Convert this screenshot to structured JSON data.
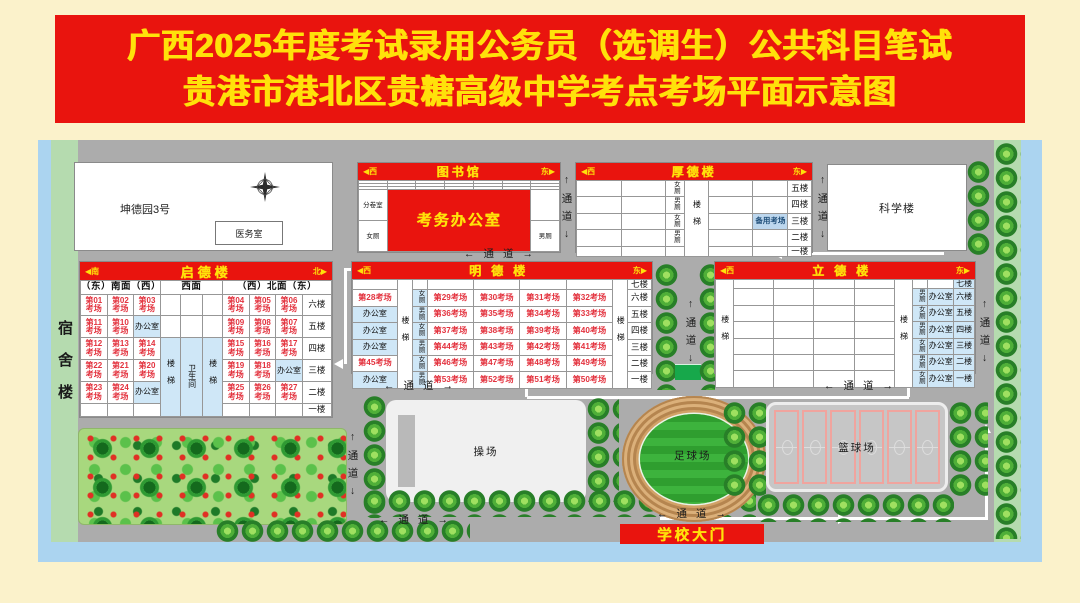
{
  "title": {
    "line1": "广西2025年度考试录用公务员（选调生）公共科目笔试",
    "line2": "贵港市港北区贵糖高级中学考点考场平面示意图"
  },
  "passage_v": "↑通道↓",
  "passage_h": "←通道→",
  "dorm": {
    "label": "宿舍楼"
  },
  "kunde": {
    "label": "坤德园3号",
    "clinic": "医务室"
  },
  "science": {
    "label": "科学楼"
  },
  "oper": {
    "label": "操场"
  },
  "football": {
    "label": "足球场"
  },
  "basketball": {
    "label": "篮球场"
  },
  "gate": {
    "label": "学校大门"
  },
  "library": {
    "dl": "◀西",
    "name": "图书馆",
    "dr": "东▶",
    "grid": {
      "colw": [
        14.3,
        14.3,
        14.3,
        14.3,
        14.3,
        14.3,
        14.2
      ],
      "rows": [
        [
          "",
          "",
          "",
          "",
          "",
          "",
          ""
        ],
        [
          "",
          "",
          "",
          "",
          "",
          "",
          ""
        ],
        [
          "",
          "",
          "",
          "",
          "",
          "",
          ""
        ],
        [
          {
            "t": "分卷室",
            "c": "tiny"
          },
          {
            "t": "考务办公室",
            "c": "banner",
            "cs": 5,
            "rs": 2
          },
          ""
        ],
        [
          {
            "t": "女厕",
            "c": "tiny"
          },
          {
            "t": "男厕",
            "c": "tiny"
          }
        ]
      ]
    }
  },
  "houde": {
    "dl": "◀西",
    "name": "厚德楼",
    "dr": "东▶",
    "grid": {
      "colw": [
        19,
        19,
        8,
        10,
        19,
        15,
        10
      ],
      "rows": [
        [
          "",
          "",
          {
            "t": "女厕",
            "c": "w"
          },
          {
            "t": "楼梯",
            "c": "s st",
            "rs": 5
          },
          "",
          "",
          {
            "t": "五楼",
            "c": "f"
          }
        ],
        [
          "",
          "",
          {
            "t": "男厕",
            "c": "w"
          },
          "",
          "",
          {
            "t": "四楼",
            "c": "f"
          }
        ],
        [
          "",
          "",
          {
            "t": "女厕",
            "c": "w"
          },
          "",
          {
            "t": "备用考场",
            "c": "bk"
          },
          {
            "t": "三楼",
            "c": "f"
          }
        ],
        [
          "",
          "",
          {
            "t": "男厕",
            "c": "w"
          },
          "",
          "",
          {
            "t": "二楼",
            "c": "f"
          }
        ],
        [
          "",
          "",
          "",
          "",
          "",
          {
            "t": "一楼",
            "c": "f"
          }
        ]
      ]
    }
  },
  "qide": {
    "dl": "◀南",
    "name": "启德楼",
    "dr": "北▶",
    "grid": {
      "colw": [
        10.6,
        10.6,
        10.6,
        8,
        8.8,
        8,
        10.6,
        10.6,
        10.6,
        11.6
      ],
      "rows": [
        [
          {
            "t": "（东）南面（西）",
            "c": "sub",
            "cs": 3
          },
          {
            "t": "西面",
            "c": "sub",
            "cs": 3
          },
          {
            "t": "（西）北面（东）",
            "c": "sub",
            "cs": 4
          }
        ],
        [
          {
            "t": "第01\n考场",
            "c": "e"
          },
          {
            "t": "第02\n考场",
            "c": "e"
          },
          {
            "t": "第03\n考场",
            "c": "e"
          },
          "",
          "",
          "",
          {
            "t": "第04\n考场",
            "c": "e"
          },
          {
            "t": "第05\n考场",
            "c": "e"
          },
          {
            "t": "第06\n考场",
            "c": "e"
          },
          {
            "t": "六楼",
            "c": "f"
          }
        ],
        [
          {
            "t": "第11\n考场",
            "c": "e"
          },
          {
            "t": "第10\n考场",
            "c": "e"
          },
          {
            "t": "办公室",
            "c": "o"
          },
          "",
          "",
          "",
          {
            "t": "第09\n考场",
            "c": "e"
          },
          {
            "t": "第08\n考场",
            "c": "e"
          },
          {
            "t": "第07\n考场",
            "c": "e"
          },
          {
            "t": "五楼",
            "c": "f"
          }
        ],
        [
          {
            "t": "第12\n考场",
            "c": "e"
          },
          {
            "t": "第13\n考场",
            "c": "e"
          },
          {
            "t": "第14\n考场",
            "c": "e"
          },
          {
            "t": "楼梯",
            "c": "s b st",
            "rs": 4
          },
          {
            "t": "卫生间",
            "c": "s b",
            "rs": 4
          },
          {
            "t": "楼梯",
            "c": "s b st",
            "rs": 4
          },
          {
            "t": "第15\n考场",
            "c": "e"
          },
          {
            "t": "第16\n考场",
            "c": "e"
          },
          {
            "t": "第17\n考场",
            "c": "e"
          },
          {
            "t": "四楼",
            "c": "f"
          }
        ],
        [
          {
            "t": "第22\n考场",
            "c": "e"
          },
          {
            "t": "第21\n考场",
            "c": "e"
          },
          {
            "t": "第20\n考场",
            "c": "e"
          },
          {
            "t": "第19\n考场",
            "c": "e"
          },
          {
            "t": "第18\n考场",
            "c": "e"
          },
          {
            "t": "办公室",
            "c": "o"
          },
          {
            "t": "三楼",
            "c": "f"
          }
        ],
        [
          {
            "t": "第23\n考场",
            "c": "e"
          },
          {
            "t": "第24\n考场",
            "c": "e"
          },
          {
            "t": "办公室",
            "c": "o"
          },
          {
            "t": "第25\n考场",
            "c": "e"
          },
          {
            "t": "第26\n考场",
            "c": "e"
          },
          {
            "t": "第27\n考场",
            "c": "e"
          },
          {
            "t": "二楼",
            "c": "f"
          }
        ],
        [
          "",
          "",
          "",
          "",
          "",
          "",
          {
            "t": "一楼",
            "c": "f"
          }
        ]
      ]
    }
  },
  "mingde": {
    "dl": "◀西",
    "name": "明德楼",
    "dr": "东▶",
    "grid": {
      "colw": [
        15,
        5,
        5,
        15.5,
        15.5,
        15.5,
        15.5,
        5,
        8
      ],
      "rows": [
        [
          "",
          {
            "t": "楼梯",
            "c": "s st",
            "rs": 7
          },
          "",
          "",
          "",
          "",
          "",
          {
            "t": "楼梯",
            "c": "s st",
            "rs": 7
          },
          {
            "t": "七楼",
            "c": "f"
          }
        ],
        [
          {
            "t": "第28考场",
            "c": "e1"
          },
          {
            "t": "女厕",
            "c": "w b"
          },
          {
            "t": "第29考场",
            "c": "e1"
          },
          {
            "t": "第30考场",
            "c": "e1"
          },
          {
            "t": "第31考场",
            "c": "e1"
          },
          {
            "t": "第32考场",
            "c": "e1"
          },
          {
            "t": "六楼",
            "c": "f"
          }
        ],
        [
          {
            "t": "办公室",
            "c": "o"
          },
          {
            "t": "男厕",
            "c": "w b"
          },
          {
            "t": "第36考场",
            "c": "e1"
          },
          {
            "t": "第35考场",
            "c": "e1"
          },
          {
            "t": "第34考场",
            "c": "e1"
          },
          {
            "t": "第33考场",
            "c": "e1"
          },
          {
            "t": "五楼",
            "c": "f"
          }
        ],
        [
          {
            "t": "办公室",
            "c": "o"
          },
          {
            "t": "女厕",
            "c": "w b"
          },
          {
            "t": "第37考场",
            "c": "e1"
          },
          {
            "t": "第38考场",
            "c": "e1"
          },
          {
            "t": "第39考场",
            "c": "e1"
          },
          {
            "t": "第40考场",
            "c": "e1"
          },
          {
            "t": "四楼",
            "c": "f"
          }
        ],
        [
          {
            "t": "办公室",
            "c": "o"
          },
          {
            "t": "男厕",
            "c": "w b"
          },
          {
            "t": "第44考场",
            "c": "e1"
          },
          {
            "t": "第43考场",
            "c": "e1"
          },
          {
            "t": "第42考场",
            "c": "e1"
          },
          {
            "t": "第41考场",
            "c": "e1"
          },
          {
            "t": "三楼",
            "c": "f"
          }
        ],
        [
          {
            "t": "第45考场",
            "c": "e1"
          },
          {
            "t": "女厕",
            "c": "w b"
          },
          {
            "t": "第46考场",
            "c": "e1"
          },
          {
            "t": "第47考场",
            "c": "e1"
          },
          {
            "t": "第48考场",
            "c": "e1"
          },
          {
            "t": "第49考场",
            "c": "e1"
          },
          {
            "t": "二楼",
            "c": "f"
          }
        ],
        [
          {
            "t": "办公室",
            "c": "o"
          },
          {
            "t": "男厕",
            "c": "w b"
          },
          {
            "t": "第53考场",
            "c": "e1"
          },
          {
            "t": "第52考场",
            "c": "e1"
          },
          {
            "t": "第51考场",
            "c": "e1"
          },
          {
            "t": "第50考场",
            "c": "e1"
          },
          {
            "t": "一楼",
            "c": "f"
          }
        ]
      ]
    }
  },
  "lide": {
    "dl": "◀西",
    "name": "立德楼",
    "dr": "东▶",
    "grid": {
      "colw": [
        7,
        15.5,
        15.5,
        15.5,
        15.5,
        7,
        6,
        10,
        8
      ],
      "rows": [
        [
          {
            "t": "楼梯",
            "c": "s st",
            "rs": 7
          },
          "",
          "",
          "",
          "",
          {
            "t": "楼梯",
            "c": "s st",
            "rs": 7
          },
          "",
          "",
          {
            "t": "七楼",
            "c": "fb"
          }
        ],
        [
          "",
          "",
          "",
          "",
          {
            "t": "男厕",
            "c": "w b"
          },
          {
            "t": "办公室",
            "c": "o"
          },
          {
            "t": "六楼",
            "c": "fb"
          }
        ],
        [
          "",
          "",
          "",
          "",
          {
            "t": "女厕",
            "c": "w b"
          },
          {
            "t": "办公室",
            "c": "o"
          },
          {
            "t": "五楼",
            "c": "fb"
          }
        ],
        [
          "",
          "",
          "",
          "",
          {
            "t": "男厕",
            "c": "w b"
          },
          {
            "t": "办公室",
            "c": "o"
          },
          {
            "t": "四楼",
            "c": "fb"
          }
        ],
        [
          "",
          "",
          "",
          "",
          {
            "t": "女厕",
            "c": "w b"
          },
          {
            "t": "办公室",
            "c": "o"
          },
          {
            "t": "三楼",
            "c": "fb"
          }
        ],
        [
          "",
          "",
          "",
          "",
          {
            "t": "男厕",
            "c": "w b"
          },
          {
            "t": "办公室",
            "c": "o"
          },
          {
            "t": "二楼",
            "c": "fb"
          }
        ],
        [
          "",
          "",
          "",
          "",
          {
            "t": "女厕",
            "c": "w b"
          },
          {
            "t": "办公室",
            "c": "o"
          },
          {
            "t": "一楼",
            "c": "fb"
          }
        ]
      ]
    }
  }
}
